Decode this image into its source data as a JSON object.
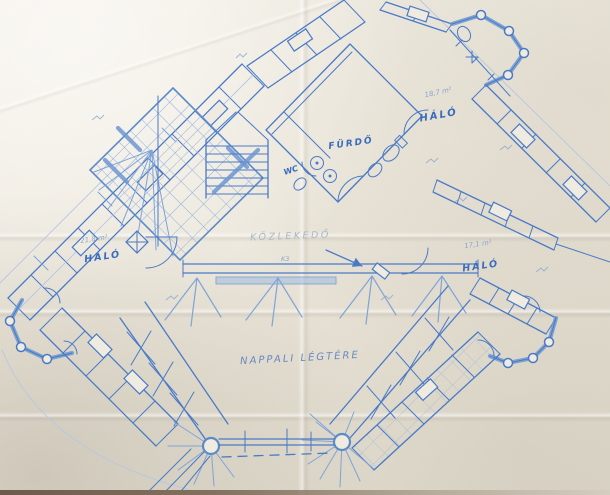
{
  "photo": {
    "description": "Hand-drawn blueprint floor plan on creased paper"
  },
  "plan": {
    "ink_color": "#4a7ac6",
    "paper_color": "#ece7db",
    "rooms": [
      {
        "id": "bedroom-left",
        "label": "HÁLÓ",
        "area": "21,8 m²"
      },
      {
        "id": "bedroom-top",
        "label": "HÁLÓ",
        "area": "18,7 m²"
      },
      {
        "id": "bedroom-right",
        "label": "HÁLÓ",
        "area": "17,1 m²"
      },
      {
        "id": "bathroom",
        "label": "FÜRDŐ",
        "area": ""
      },
      {
        "id": "wc",
        "label": "WC",
        "area": ""
      },
      {
        "id": "hallway",
        "label": "KÖZLEKEDŐ",
        "area": ""
      },
      {
        "id": "living-void",
        "label": "NAPPALI LÉGTÉRE",
        "area": ""
      }
    ],
    "marks": {
      "beam": "K3"
    }
  }
}
